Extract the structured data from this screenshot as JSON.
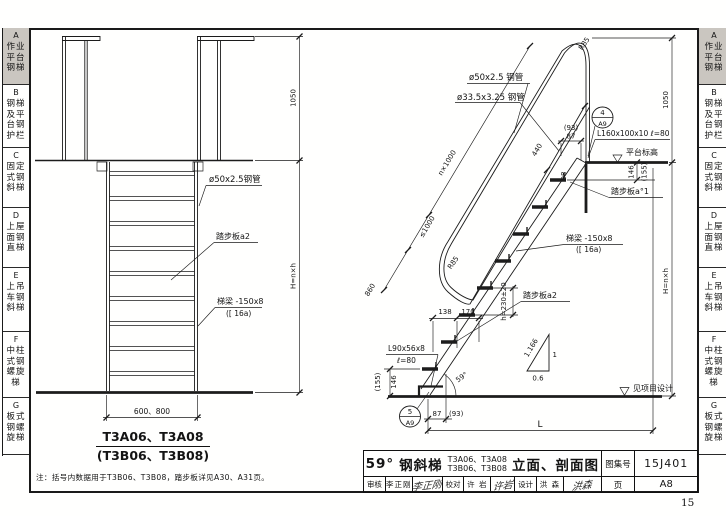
{
  "page": {
    "sheet_number": "15"
  },
  "sidebar": {
    "tabs": [
      {
        "letter": "A",
        "label": "作业平台钢梯",
        "active": true
      },
      {
        "letter": "B",
        "label": "钢梯及平台钢护栏",
        "active": false
      },
      {
        "letter": "C",
        "label": "固定式钢斜梯",
        "active": false
      },
      {
        "letter": "D",
        "label": "上屋面钢直梯",
        "active": false
      },
      {
        "letter": "E",
        "label": "上吊车钢斜梯",
        "active": false
      },
      {
        "letter": "F",
        "label": "中柱式钢螺旋梯",
        "active": false
      },
      {
        "letter": "G",
        "label": "板式钢螺旋梯",
        "active": false
      }
    ]
  },
  "front_view": {
    "labels": {
      "handrail_pipe": "ø50x2.5钢管",
      "tread": "踏步板a2",
      "stringer_line1": "梯梁 -150x8",
      "stringer_line2": "([ 16a)"
    },
    "dims": {
      "rail_height": "1050",
      "total_height": "H=n×h",
      "width": "600、800"
    },
    "title_line1": "T3A06、T3A08",
    "title_line2": "(T3B06、T3B08)"
  },
  "side_view": {
    "labels": {
      "handrail_pipe": "ø50x2.5 钢管",
      "middle_rail_pipe": "ø33.5x3.25 钢管",
      "radius_top": "R85",
      "radius_bottom": "R85",
      "tread_top": "踏步板a°1",
      "stringer_line1": "梯梁 -150x8",
      "stringer_line2": "([ 16a)",
      "tread": "踏步板a2",
      "base_angle_line1": "L90x56x8",
      "base_angle_line2": "ℓ=80",
      "top_angle": "L160x100x10 ℓ=80",
      "platform_level": "平台标高",
      "ground_note": "见项目设计"
    },
    "dims": {
      "slope_total": "n×1000",
      "slope_rest": "≤1000",
      "slope_bottom": "860",
      "rail_segment": "440",
      "top_offset_paren": "(93)",
      "top_offset": "87",
      "top_drop": "146",
      "top_drop_paren": "(155)",
      "tread_width": "98",
      "step_going_1": "138",
      "step_going_2": "170",
      "step_rise": "h=230±20",
      "bottom_rise": "146",
      "bottom_rise_paren": "(155)",
      "base_offset": "87",
      "base_offset_paren": "(93)",
      "total_run": "L",
      "rail_height": "1050",
      "total_height": "H=n×h",
      "angle": "59°",
      "ratio_hyp": "1.166",
      "ratio_rise": "1",
      "ratio_run": "0.6"
    },
    "details": {
      "top_number": "4",
      "top_sheet": "A9",
      "bottom_number": "5",
      "bottom_sheet": "A9"
    }
  },
  "note": "注：括号内数据用于T3B06、T3B08，踏步板详见A30、A31页。",
  "title_block": {
    "angle": "59°",
    "product": "钢斜梯",
    "models_line1": "T3A06、T3A08",
    "models_line2": "T3B06、T3B08",
    "suffix": "立面、剖面图",
    "atlas_label": "图集号",
    "atlas_number": "15J401",
    "page_label": "页",
    "page_number": "A8",
    "reviewers": [
      {
        "role": "审核",
        "name": "李正刚",
        "signature": "李正刚"
      },
      {
        "role": "校对",
        "name": "许 岩",
        "signature": "许岩"
      },
      {
        "role": "设计",
        "name": "洪 森",
        "signature": "洪森"
      }
    ]
  }
}
